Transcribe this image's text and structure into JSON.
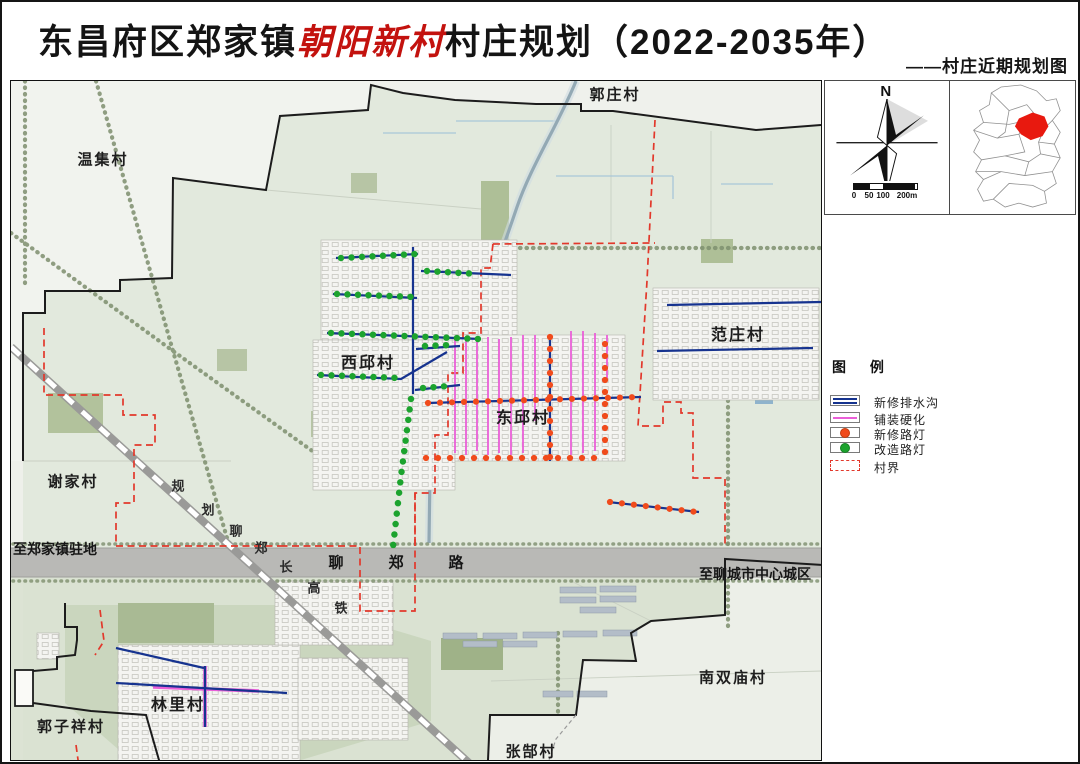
{
  "title": {
    "prefix": "东昌府区郑家镇",
    "highlight": "朝阳新村",
    "suffix": "村庄规划（2022-2035年）",
    "subtitle": "——村庄近期规划图"
  },
  "map": {
    "villages": [
      {
        "name": "郭庄村"
      },
      {
        "name": "温集村"
      },
      {
        "name": "西邱村"
      },
      {
        "name": "东邱村"
      },
      {
        "name": "范庄村"
      },
      {
        "name": "谢家村"
      },
      {
        "name": "林里村"
      },
      {
        "name": "郭子祥村"
      },
      {
        "name": "张郜村"
      },
      {
        "name": "南双庙村"
      }
    ],
    "road_west_label": "至郑家镇驻地",
    "road_east_label": "至聊城市中心城区",
    "road_chars": [
      "聊",
      "郑",
      "路"
    ],
    "railway_chars": [
      "规",
      "划",
      "聊",
      "郑",
      "长",
      "高",
      "铁"
    ]
  },
  "sidebar": {
    "north_label": "N",
    "scale_ticks": [
      "0",
      "50",
      "100",
      "200m"
    ],
    "legend_title": "图 例",
    "legend": [
      {
        "label": "新修排水沟",
        "type": "line-blue"
      },
      {
        "label": "铺装硬化",
        "type": "line-magenta"
      },
      {
        "label": "新修路灯",
        "type": "dot-orange"
      },
      {
        "label": "改造路灯",
        "type": "dot-green"
      },
      {
        "label": "村界",
        "type": "dash-red"
      }
    ],
    "colors": {
      "drain_blue": "#16338f",
      "pave_magenta": "#ea5fd8",
      "new_lamp_orange": "#f04b1c",
      "renovated_lamp_green": "#1ca32e",
      "village_boundary_red": "#e2382b"
    }
  }
}
